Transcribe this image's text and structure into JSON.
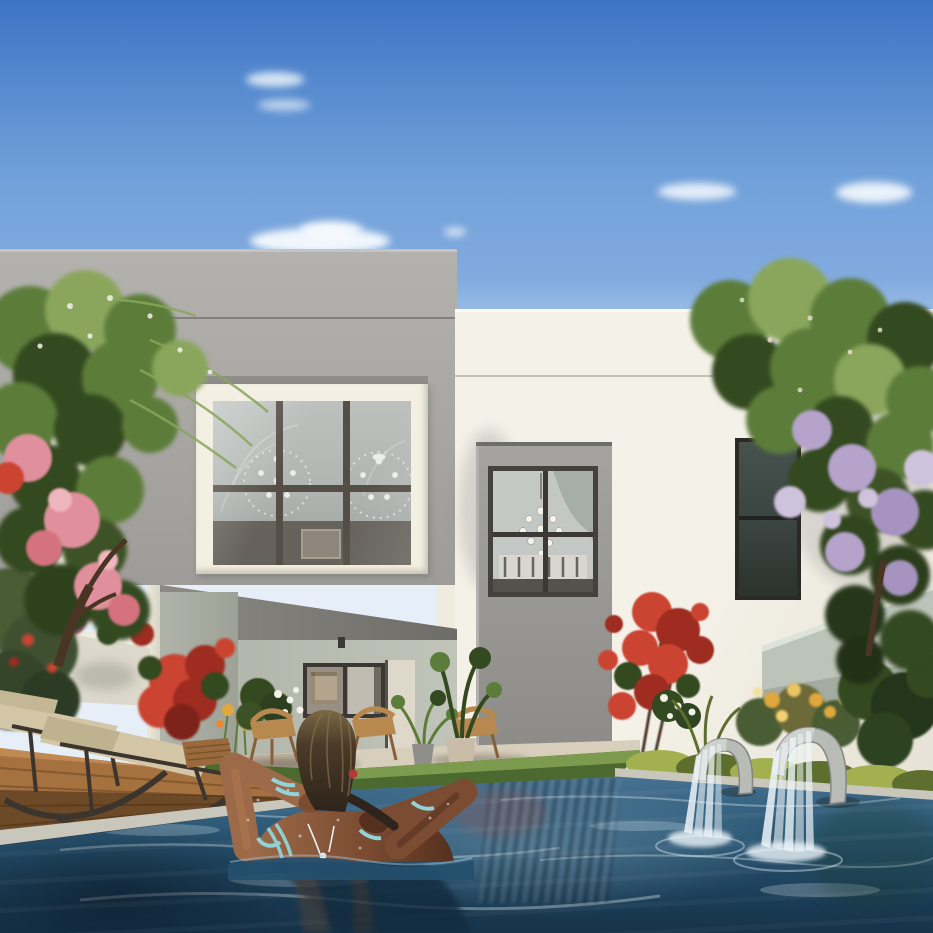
{
  "scene": {
    "title": "Modern villa with private pool",
    "description": "Photorealistic architectural rendering: rear garden of a modern two-storey villa (grey cube volume with large six-pane picture window, cream volume with tall recessed window and sliding glass door to a dining room with pendant lamps). A woman with wet dark hair relaxes in the blue swimming pool with her hands behind her head, wearing teal bracelets and a silver necklace. Flowering trees (pink-red left, lavender-purple right), red bougainvillea climbing the wall, sun loungers on a wooden deck, wooden dining chairs and potted plants on the patio, yellow-green hedges, and two arched waterfall fountains spilling into the pool under a clear blue sky with small clouds.",
    "time_of_day": "sunny afternoon",
    "elements": [
      "sky",
      "clouds",
      "left-villa-gray-block",
      "picture-window",
      "window-mullions",
      "chandelier-reflections",
      "right-villa-white-block",
      "facade-seam",
      "window-niche",
      "upper-niche-window",
      "wall-sconce",
      "sliding-glass-door",
      "interior-louvers",
      "pendant-lamps",
      "dining-set",
      "bedroom-window",
      "patio-recess",
      "patio-window",
      "patio-artwork",
      "wooden-dining-chairs",
      "potted-plants",
      "left-garden-wall",
      "right-garden-wall",
      "pink-flowering-tree",
      "purple-flowering-tree",
      "red-bougainvillea",
      "white-flowers",
      "yellow-flowers",
      "hedge",
      "rocking-sun-loungers",
      "wooden-deck",
      "pool-coping",
      "waterline-tiles",
      "swimming-pool",
      "pool-reflections",
      "waterfall-fountain-small",
      "waterfall-fountain-large",
      "woman-in-pool",
      "teal-bracelets",
      "silver-necklace"
    ]
  },
  "colors": {
    "sky_top": "#3d74c4",
    "sky_mid": "#6f9fd9",
    "sky_low": "#a9c8ec",
    "cloud_white": "#f7fbfe",
    "gray_facade": "#a9a7a3",
    "cream_frame": "#f3efe2",
    "mullion": "#554e47",
    "white_facade": "#f4f1e8",
    "white_facade_shade": "#e6e2d5",
    "white_seam": "#c5c1b4",
    "lamp_white": "#eeeae1",
    "art_tan": "#b3a48e",
    "chair_wood": "#b8894f",
    "chair_wood_dark": "#86603a",
    "lounger_frame": "#3b352e",
    "cushion_beige": "#d3c6a7",
    "deck_wood": "#a5713f",
    "deck_wood_dark": "#67421f",
    "path_stone": "#d8cebc",
    "coping_stone": "#c9c6bc",
    "waterline_tile": "#31424e",
    "grass_light": "#7d9b4e",
    "grass_dark": "#4c6a2f",
    "hedge_yellow": "#a3b050",
    "hedge_dark": "#5d6e2e",
    "foliage_light": "#8aa65c",
    "foliage_mid": "#5c7d3a",
    "foliage_dark": "#33491f",
    "foliage_olive": "#4a5c33",
    "flower_red": "#cb4431",
    "flower_red_dark": "#9e2c20",
    "flower_pink": "#e08f9c",
    "flower_magenta": "#c06090",
    "flower_purple": "#b5a3cb",
    "flower_purple_light": "#cfc2dd",
    "flower_yellow": "#e0a83c",
    "flower_white": "#f2f2e8",
    "trunk_brown": "#4a3423",
    "skin_light": "#9c6a48",
    "skin_mid": "#7c4c32",
    "skin_dark": "#55301f",
    "hair_dark": "#2e241b",
    "hair_light": "#7c6847",
    "bracelet_teal": "#8fd4d8",
    "necklace_silver": "#e9eff3",
    "fountain_metal": "#b8bbb6",
    "fountain_metal_dark": "#838683",
    "water_white": "#ecf5f9",
    "pot_gray": "#8f8e8a",
    "pot_beige": "#c9bda9",
    "shadow_tint": "rgba(40,45,55,0.16)"
  }
}
